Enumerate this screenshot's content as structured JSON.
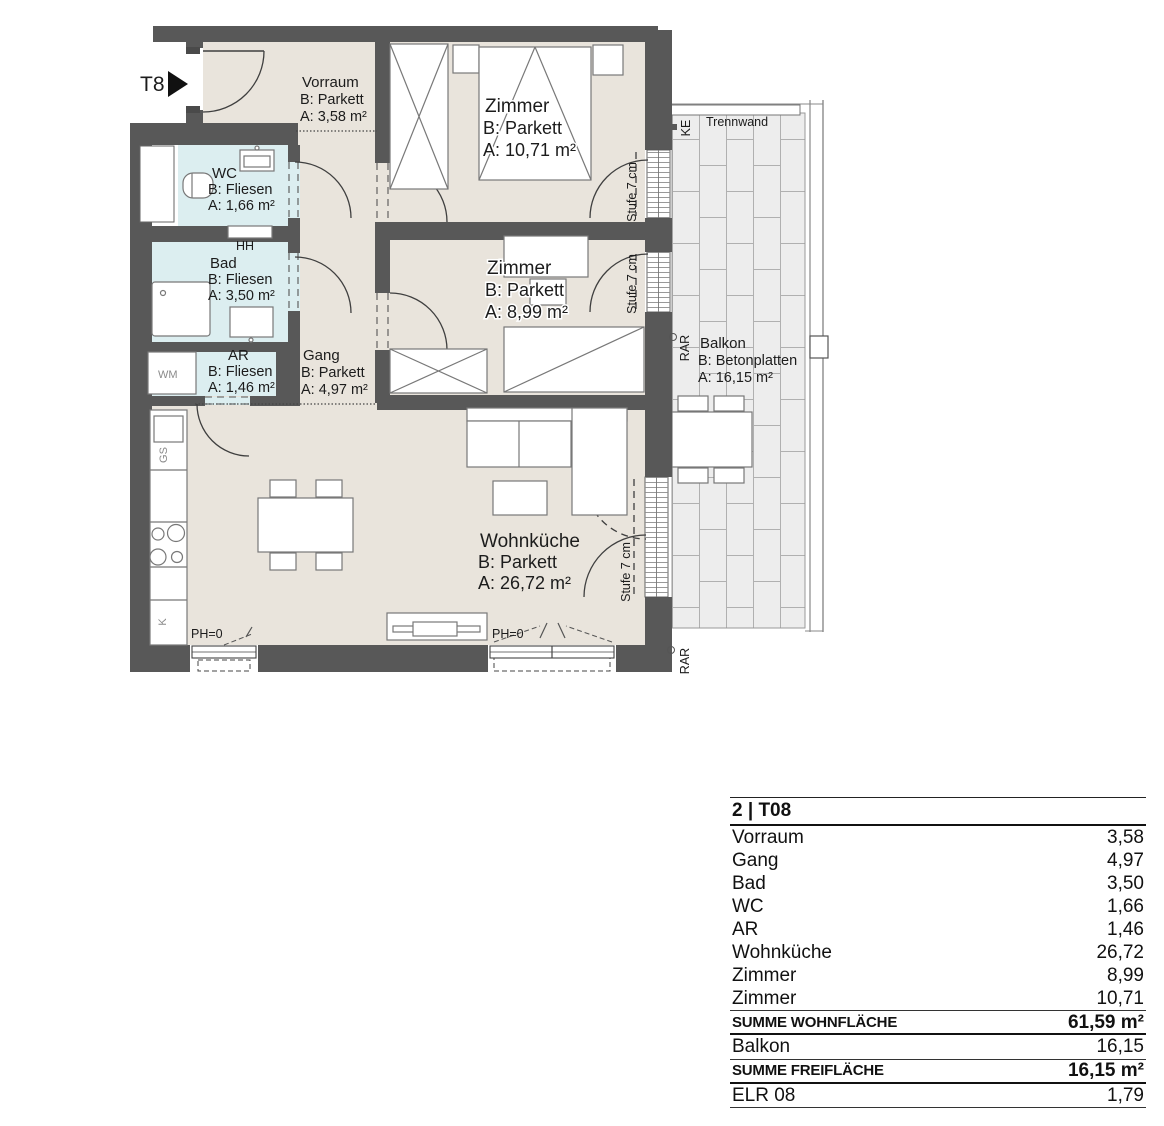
{
  "plan": {
    "unit_marker": "T8",
    "rooms": {
      "vorraum": {
        "name": "Vorraum",
        "floor": "B: Parkett",
        "area": "A: 3,58 m²"
      },
      "zimmer_top": {
        "name": "Zimmer",
        "floor": "B: Parkett",
        "area": "A: 10,71 m²"
      },
      "wc": {
        "name": "WC",
        "floor": "B: Fliesen",
        "area": "A: 1,66 m²"
      },
      "bad": {
        "name": "Bad",
        "floor": "B: Fliesen",
        "area": "A: 3,50 m²"
      },
      "ar": {
        "name": "AR",
        "floor": "B: Fliesen",
        "area": "A: 1,46 m²"
      },
      "gang": {
        "name": "Gang",
        "floor": "B: Parkett",
        "area": "A: 4,97 m²"
      },
      "zimmer_mid": {
        "name": "Zimmer",
        "floor": "B: Parkett",
        "area": "A: 8,99 m²"
      },
      "wohnkueche": {
        "name": "Wohnküche",
        "floor": "B: Parkett",
        "area": "A: 26,72 m²"
      },
      "balkon": {
        "name": "Balkon",
        "floor": "B: Betonplatten",
        "area": "A: 16,15 m²"
      }
    },
    "annotations": {
      "trennwand": "Trennwand",
      "ke": "KE",
      "rar": "RAR",
      "hh": "HH",
      "wm": "WM",
      "gs": "GS",
      "k": "K",
      "ph0": "PH=0",
      "stufe": "Stufe 7 cm"
    }
  },
  "table": {
    "header": "2 | T08",
    "rows": [
      {
        "label": "Vorraum",
        "value": "3,58"
      },
      {
        "label": "Gang",
        "value": "4,97"
      },
      {
        "label": "Bad",
        "value": "3,50"
      },
      {
        "label": "WC",
        "value": "1,66"
      },
      {
        "label": "AR",
        "value": "1,46"
      },
      {
        "label": "Wohnküche",
        "value": "26,72"
      },
      {
        "label": "Zimmer",
        "value": "8,99"
      },
      {
        "label": "Zimmer",
        "value": "10,71"
      }
    ],
    "sum_living": {
      "label": "SUMME WOHNFLÄCHE",
      "value": "61,59 m²"
    },
    "balkon_row": {
      "label": "Balkon",
      "value": "16,15"
    },
    "sum_outdoor": {
      "label": "SUMME FREIFLÄCHE",
      "value": "16,15 m²"
    },
    "elr_row": {
      "label": "ELR 08",
      "value": "1,79"
    }
  },
  "colors": {
    "wall": "#585858",
    "parkett_floor": "#e9e4dc",
    "fliesen_floor": "#dceef0",
    "balcony_tile": "#ededed"
  }
}
